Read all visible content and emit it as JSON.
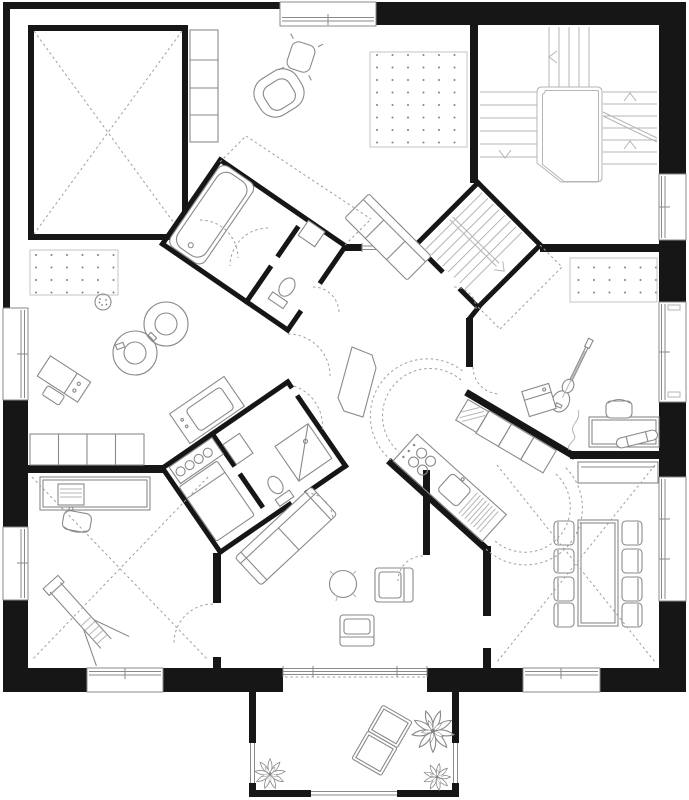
{
  "plan": {
    "colors": {
      "wall": "#161616",
      "furniture": "#8a8a8a",
      "furniture_light": "#b5b5b5",
      "dashed": "#9f9f9f",
      "window": "#8a8a8a",
      "carpet_dot": "#808080",
      "background": "#ffffff"
    }
  },
  "labels": {
    "plan": "residential floor plan drawing",
    "exterior_walls": "exterior walls",
    "windows": "windows",
    "void_room": "double-height void with cross marking",
    "shelf_unit": "shelf unit",
    "armchair": "round armchair",
    "ottoman": "ottoman cushion",
    "dot_rug_top": "dotted rug",
    "dot_rug_left": "dotted rug",
    "dot_rug_right": "dotted rug",
    "bench_sofa": "bench sofa",
    "stair_hall": "main staircase with landing",
    "basement_stair": "secondary stair pod",
    "nw_bathroom": "bathroom pod with bathtub and toilet",
    "sw_bathroom": "bathroom pod with shower, toilet, bed and kitchenette",
    "bathtub": "bathtub",
    "toilet": "toilet",
    "shower": "shower",
    "bed": "bed",
    "kitchenette": "kitchenette counter",
    "fridge": "tall appliance cabinet",
    "hall_table": "freestanding hall table",
    "wardrobe_zone": "dotted wardrobe zone",
    "racetrack": "figure-eight toy racetrack",
    "ball": "speckled play ball",
    "toy_bench": "toy workbench and stool",
    "wall_cabinets": "low cabinet row",
    "study_desk": "desk with work lamp and machine",
    "desk_chair": "desk chair",
    "easel": "easel ladder",
    "kitchen": "galley kitchen",
    "kitchen_counter": "kitchen counter with hob and sink",
    "kitchen_cabinets": "kitchen cabinet row",
    "sofa": "large sofa",
    "coffee_table": "round coffee table",
    "armchair_a": "armchair",
    "armchair_b": "armchair",
    "dining_table": "dining table",
    "dining_chair": "dining chair",
    "sideboard": "sideboard",
    "music_desk": "desk",
    "office_chair": "chair",
    "skateboard": "skateboard",
    "guitar": "electric guitar with cable",
    "amp": "guitar amplifier",
    "balcony": "balcony terrace",
    "lounge_chair": "lounge chair",
    "plant": "potted plant",
    "door_swing": "door swing arc"
  }
}
